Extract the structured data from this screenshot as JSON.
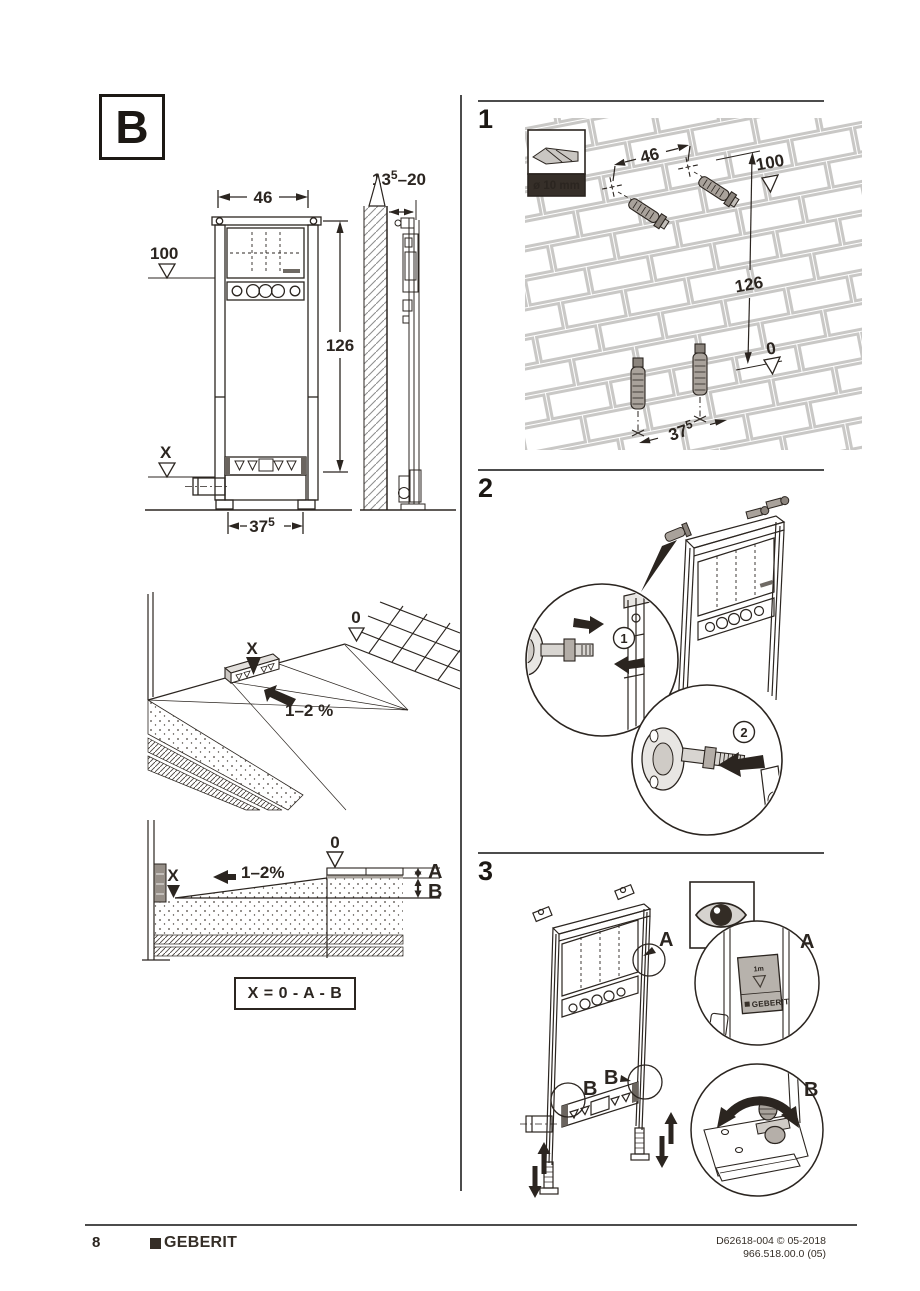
{
  "page": {
    "section_label": "B",
    "footer": {
      "page_number": "8",
      "brand": "GEBERIT",
      "doc_code": "D62618-004 © 05-2018",
      "doc_version": "966.518.00.0 (05)"
    }
  },
  "overview": {
    "front_view": {
      "width": "46",
      "upper_level": "100",
      "height": "126",
      "floor_level": "X",
      "base_width": "37",
      "base_width_sup": "5"
    },
    "side_view": {
      "depth_base": "13",
      "depth_sup": "5",
      "depth_range": "–20"
    },
    "floor_view": {
      "zero_level": "0",
      "x_level": "X",
      "slope": "1–2 %"
    },
    "section_view": {
      "zero_level": "0",
      "x_level": "X",
      "slope": "1–2%",
      "dim_a": "A",
      "dim_b": "B"
    },
    "formula": "X = 0 - A - B"
  },
  "steps": {
    "step1": {
      "number": "1",
      "drill_diameter": "ø 10 mm",
      "width": "46",
      "upper_level": "100",
      "height": "126",
      "zero_level": "0",
      "base_width": "37",
      "base_width_sup": "5"
    },
    "step2": {
      "number": "2",
      "callout_1": "1",
      "callout_2": "2"
    },
    "step3": {
      "number": "3",
      "label_a": "A",
      "label_b": "B",
      "tag_meter": "1m",
      "tag_brand": "GEBERIT"
    }
  }
}
